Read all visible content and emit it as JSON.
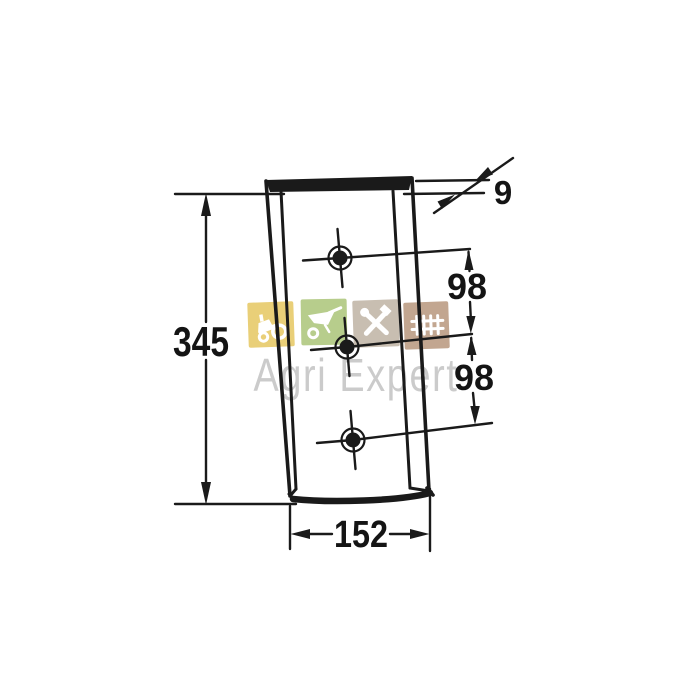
{
  "canvas": {
    "background": "#ffffff",
    "ink": "#1a1a1a"
  },
  "drawing": {
    "description": "Technical dimension drawing of a tapered wear plate with three cross-marked mounting holes",
    "labels": {
      "overall_height": "345",
      "overall_width": "152",
      "hole_spacing_upper": "98",
      "hole_spacing_lower": "98",
      "thickness": "9"
    }
  },
  "watermark": {
    "text": "Agri Expert",
    "text_color": "#cbcbcb",
    "icons": [
      {
        "name": "tractor-icon",
        "color": "#e9cf78"
      },
      {
        "name": "wheelbarrow-icon",
        "color": "#b7cd8c"
      },
      {
        "name": "tools-icon",
        "color": "#c8beb1"
      },
      {
        "name": "harrow-icon",
        "color": "#c2a690"
      }
    ]
  }
}
